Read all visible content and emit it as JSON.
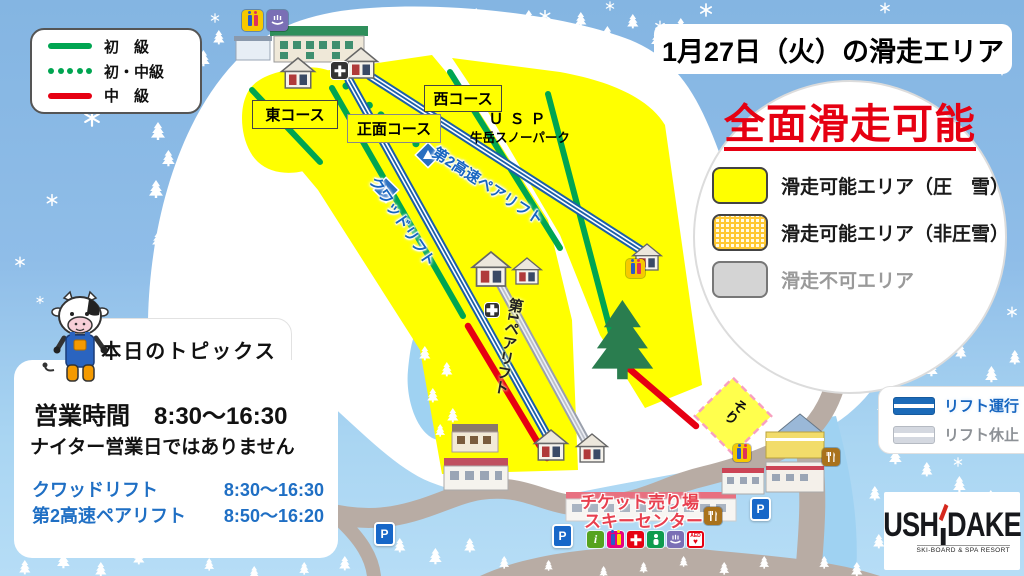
{
  "course_legend": {
    "items": [
      {
        "label": "初　級",
        "style": "solid-green"
      },
      {
        "label": "初・中級",
        "style": "dotted-green"
      },
      {
        "label": "中　級",
        "style": "solid-red"
      }
    ]
  },
  "header": {
    "title": "1月27日（火）の滑走エリア"
  },
  "status_circle": {
    "headline": "全面滑走可能",
    "items": [
      {
        "label": "滑走可能エリア（圧　雪）",
        "swatch": "yellow"
      },
      {
        "label": "滑走可能エリア（非圧雪）",
        "swatch": "yellow-dotted"
      },
      {
        "label": "滑走不可エリア",
        "swatch": "gray"
      }
    ]
  },
  "map": {
    "course_labels": {
      "east": "東コース",
      "front": "正面コース",
      "west": "西コース"
    },
    "snowpark_line1": "ＵＳＰ",
    "snowpark_line2": "牛岳スノーパーク",
    "lift_labels": {
      "pair2": "第2高速ペアリフト",
      "quad": "クワッドリフト",
      "pair1": "第1ペアリフト"
    },
    "sled": "そり",
    "parking": "P"
  },
  "topics": {
    "title": "本日のトピックス",
    "hours": "営業時間　8:30～16:30",
    "note": "ナイター営業日ではありません",
    "lifts": [
      {
        "name": "クワッドリフト",
        "time": "8:30～16:30"
      },
      {
        "name": "第2高速ペアリフト",
        "time": "8:50～16:20"
      }
    ]
  },
  "lift_legend": {
    "running": "リフト運行",
    "stopped": "リフト休止"
  },
  "base": {
    "ticket": "チケット売り場",
    "center": "スキーセンター"
  },
  "icons": {
    "info": "i",
    "aed": "AED",
    "heart": "♥"
  },
  "logo": {
    "left": "USH",
    "right": "DAKE",
    "sub": "SKI-BOARD & SPA RESORT"
  },
  "colors": {
    "beginner_green": "#00a551",
    "intermediate_red": "#e60012",
    "slope_yellow": "#ffff00",
    "lift_blue": "#1b5fa8",
    "lift_gray": "#b9bec8",
    "text_blue": "#1f6fc4",
    "accent_red": "#e60012"
  }
}
